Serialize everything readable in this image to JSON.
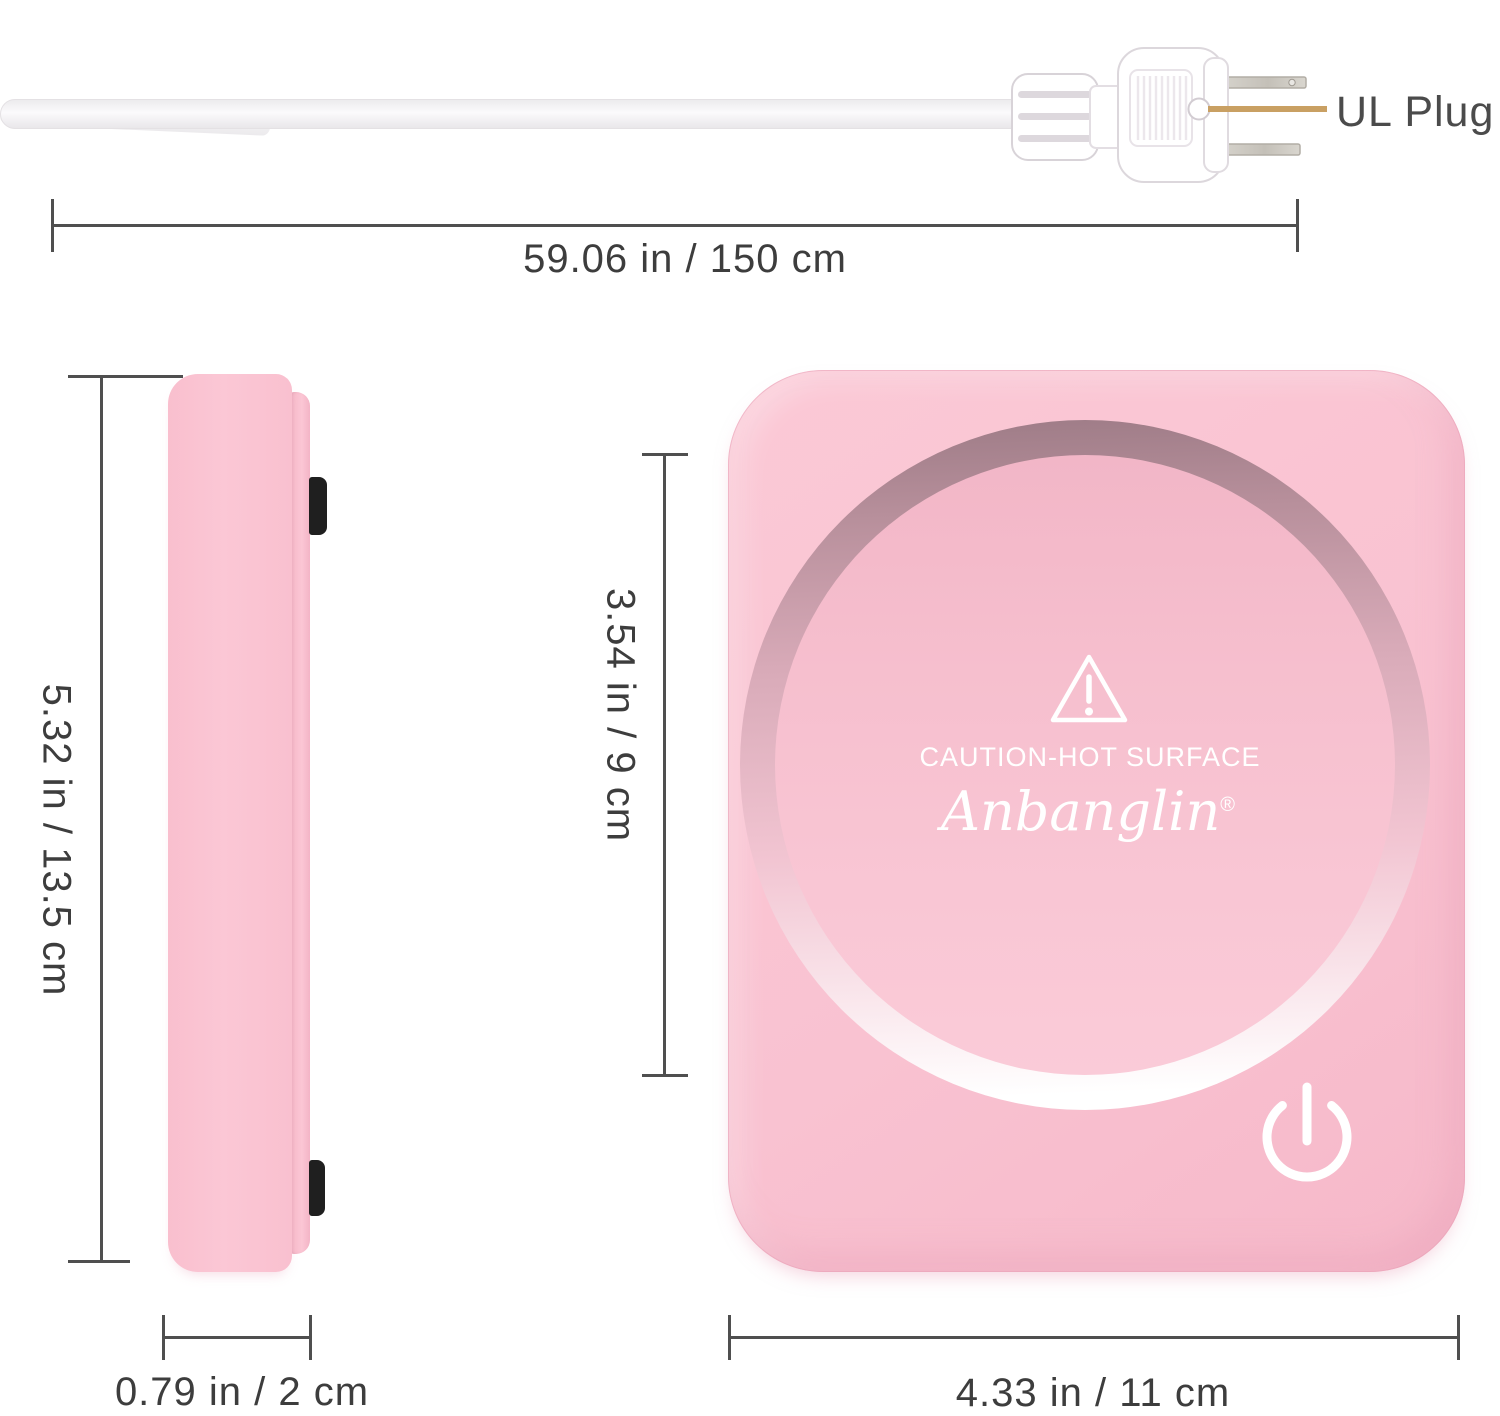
{
  "labels": {
    "ul_plug": "UL Plug"
  },
  "dimensions": {
    "cord_length": "59.06 in / 150 cm",
    "device_height": "5.32 in / 13.5 cm",
    "device_thickness": "0.79 in / 2 cm",
    "plate_diameter": "3.54 in / 9 cm",
    "device_width": "4.33 in / 11 cm"
  },
  "device": {
    "caution_text": "CAUTION-HOT SURFACE",
    "brand": "Anbanglin",
    "registered_mark": "®"
  },
  "icons": {
    "warning_triangle": "warning-triangle-icon",
    "power": "power-icon",
    "plug": "power-plug",
    "leader_line": "ul-plug-leader-line"
  },
  "colors": {
    "body-pink": "#f9c2d1",
    "body-pink-light": "#fcccd9",
    "body-pink-deep": "#f5b3c6",
    "ring-mauve": "#9d7b86",
    "plate-pink": "#f6bccb",
    "dim-line": "#4f4f4f",
    "dim-text": "#3d3d3d",
    "leader-gold": "#c9a063",
    "label-gray": "#4b4b4b",
    "print-white": "#ffffff",
    "pad-black": "#1f1f1f",
    "plug-white": "#ffffff",
    "plug-outline": "#d8d3d8",
    "prong-silver": "#c9c5be"
  }
}
